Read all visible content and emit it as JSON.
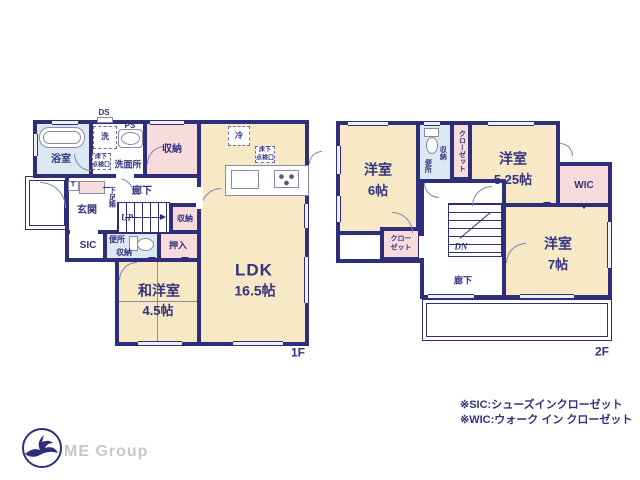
{
  "f1": {
    "floor_label": "1F",
    "ds": "DS",
    "ps": "PS",
    "washer": "洗",
    "bath": "浴室",
    "underfloor_top": "床下",
    "underfloor_bottom": "点検口",
    "washroom": "洗面所",
    "storage_top": "収納",
    "fridge": "冷",
    "t_mark": "T",
    "shoe_box": "下足箱",
    "entrance": "玄関",
    "hallway": "廊下",
    "up": "UP",
    "storage_mid": "収納",
    "sic": "SIC",
    "toilet": "便所",
    "toilet_storage": "収納",
    "oshiire": "押入",
    "jp_room": "和洋室",
    "jp_room_size": "4.5帖",
    "ldk": "LDK",
    "ldk_size": "16.5帖"
  },
  "f2": {
    "floor_label": "2F",
    "room_a": "洋室",
    "room_a_size": "6帖",
    "toilet": "便所",
    "storage": "収納",
    "closet": "クローゼット",
    "room_b": "洋室",
    "room_b_size": "5.25帖",
    "wic": "WIC",
    "room_c": "洋室",
    "room_c_size": "7帖",
    "dn": "DN",
    "hallway": "廊下",
    "closet_small_top": "クロー",
    "closet_small_bottom": "ゼット"
  },
  "notes": {
    "sic_note": "※SIC:シューズインクローゼット",
    "wic_note": "※WIC:ウォーク イン クローゼット"
  },
  "logo": {
    "company": "ME Group"
  },
  "colors": {
    "wall": "#2e2e7a",
    "text_navy": "#32327e",
    "room_cream": "#f7e8c6",
    "closet_pink": "#f8dcdc",
    "bath_blue": "#dce8f2",
    "logo_gray": "#c8c8c8"
  }
}
